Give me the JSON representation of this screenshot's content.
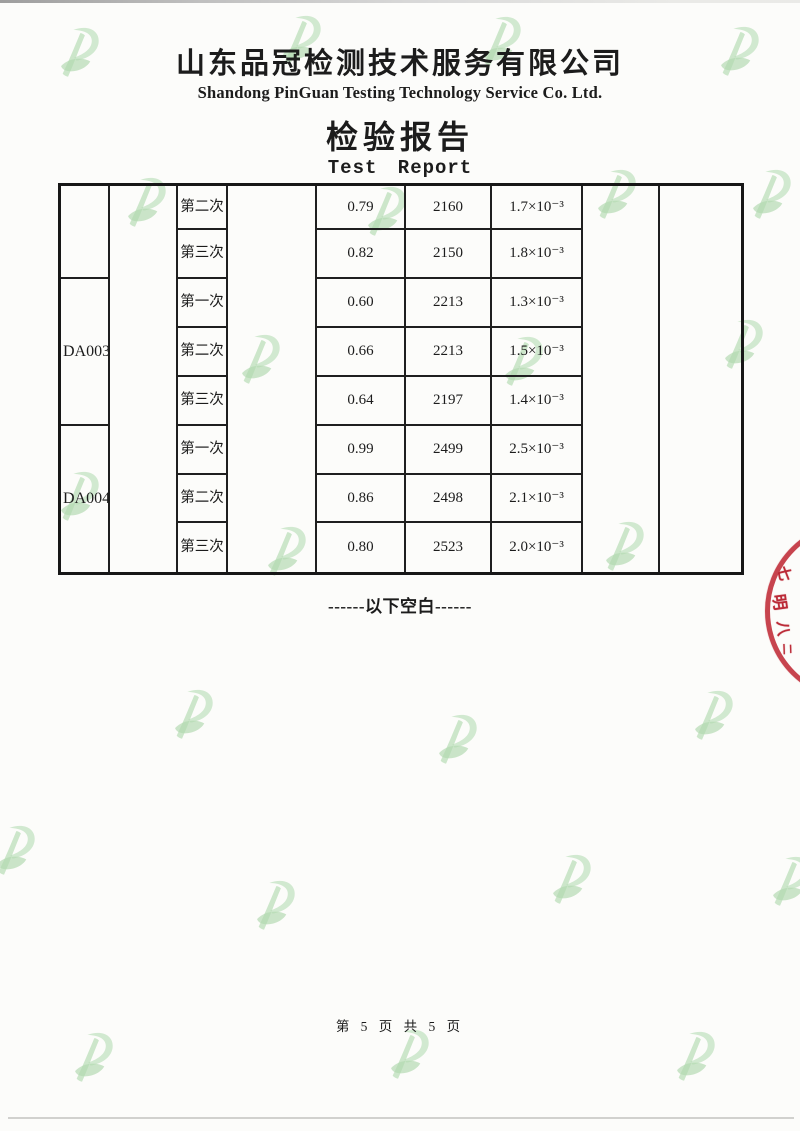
{
  "page": {
    "company_cn": "山东品冠检测技术服务有限公司",
    "company_en": "Shandong PinGuan Testing Technology Service Co. Ltd.",
    "report_title_cn": "检验报告",
    "report_title_en": "Test Report",
    "blank_note": "------以下空白------",
    "page_number": "第 5 页 共 5 页"
  },
  "table": {
    "samples": [
      {
        "id": ""
      },
      {
        "id": "DA003"
      },
      {
        "id": "DA004"
      }
    ],
    "rows": [
      {
        "trial": "第二次",
        "v1": "0.79",
        "v2": "2160",
        "v3": "1.7×10⁻³"
      },
      {
        "trial": "第三次",
        "v1": "0.82",
        "v2": "2150",
        "v3": "1.8×10⁻³"
      },
      {
        "trial": "第一次",
        "v1": "0.60",
        "v2": "2213",
        "v3": "1.3×10⁻³"
      },
      {
        "trial": "第二次",
        "v1": "0.66",
        "v2": "2213",
        "v3": "1.5×10⁻³"
      },
      {
        "trial": "第三次",
        "v1": "0.64",
        "v2": "2197",
        "v3": "1.4×10⁻³"
      },
      {
        "trial": "第一次",
        "v1": "0.99",
        "v2": "2499",
        "v3": "2.5×10⁻³"
      },
      {
        "trial": "第二次",
        "v1": "0.86",
        "v2": "2498",
        "v3": "2.1×10⁻³"
      },
      {
        "trial": "第三次",
        "v1": "0.80",
        "v2": "2523",
        "v3": "2.0×10⁻³"
      }
    ]
  },
  "stamp": {
    "chars": [
      "七",
      "明",
      "八",
      "二"
    ]
  },
  "icons": {
    "watermark": "pinguan-leaf-p-logo"
  },
  "colors": {
    "watermark_green": "#b2dab0",
    "stamp_red": "#bf2a35",
    "table_line": "#1f1f1f"
  }
}
